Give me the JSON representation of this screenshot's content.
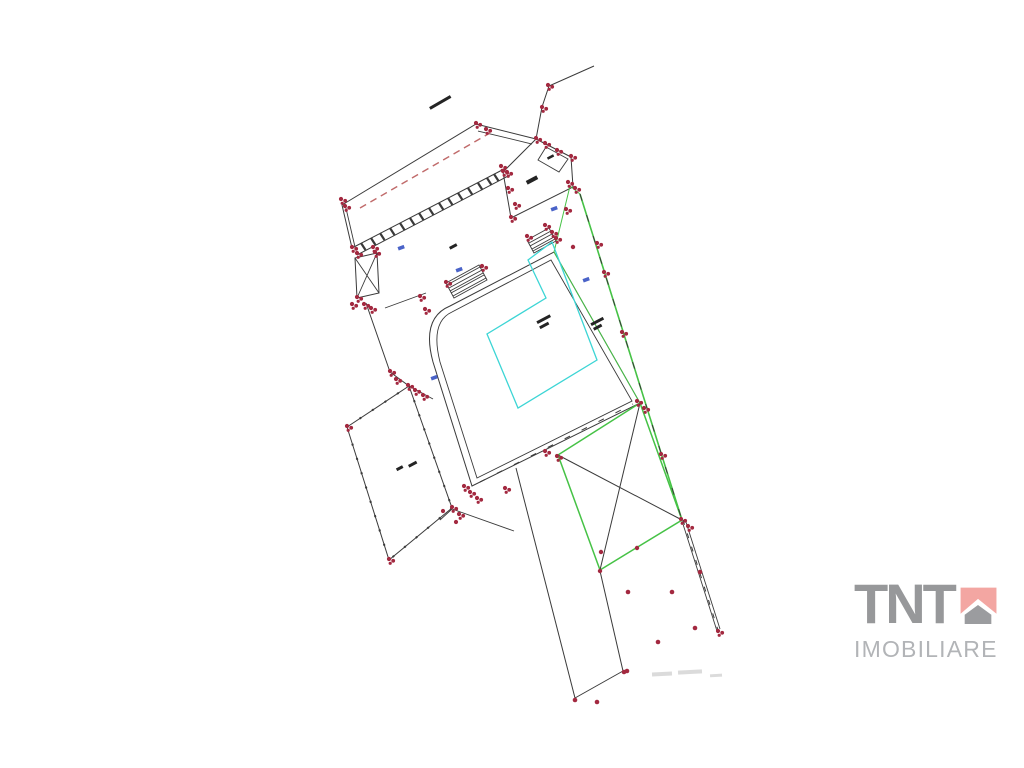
{
  "page": {
    "background_color": "#ffffff"
  },
  "plan": {
    "description": "cadastral-site-plan-drawing",
    "colors": {
      "line": "#3a3a3a",
      "survey_red": "#a32940",
      "dashed_red": "#c06a6a",
      "zone_green": "#46c246",
      "building_cyan": "#3cd5d5",
      "point_blue": "#4a63c8",
      "smudge_gray": "#c8c8c8"
    }
  },
  "logo": {
    "brand": "TNT",
    "subtitle": "IMOBILIARE",
    "colors": {
      "brand_gray": "#97989a",
      "subtitle_gray": "#b2b4b7",
      "icon_pink": "#f3a6a2",
      "icon_gray": "#9b9c9f",
      "page_bg": "#ffffff"
    }
  }
}
